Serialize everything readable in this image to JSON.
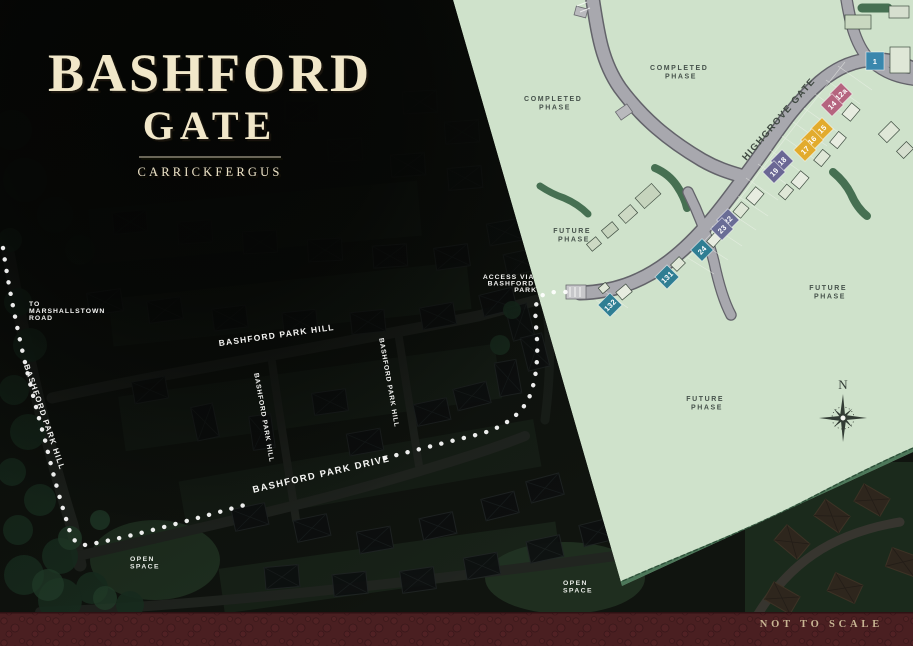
{
  "title": {
    "line1": "BASHFORD",
    "line2": "GATE",
    "subtitle": "CARRICKFERGUS"
  },
  "footer": {
    "scale_note": "NOT TO SCALE"
  },
  "aerial": {
    "to_road_lines": [
      "TO",
      "MARSHALLSTOWN",
      "ROAD"
    ],
    "park_hill": "BASHFORD PARK HILL",
    "park_drive": "BASHFORD PARK DRIVE",
    "access_lines": [
      "ACCESS VIA",
      "BASHFORD",
      "PARK"
    ],
    "open_space_lines": [
      "OPEN",
      "SPACE"
    ]
  },
  "plan": {
    "phase_completed_lines": [
      "COMPLETED",
      "PHASE"
    ],
    "phase_future_lines": [
      "FUTURE",
      "PHASE"
    ],
    "road_name": "HIGHGROVE GATE",
    "north": "N",
    "colors": {
      "plan_green": "#cfe2cb",
      "road_gray": "#a8a8ae",
      "hedge_green": "#3e694b",
      "footer_maroon": "#4a1f21",
      "title_cream": "#f1e7c9"
    },
    "plots": [
      {
        "number": "1",
        "color": "#3a87ad",
        "x": 875,
        "y": 61,
        "rot": 0,
        "size": 18
      },
      {
        "number": "12a",
        "color": "#b5647f",
        "x": 841,
        "y": 94,
        "rot": -45,
        "size": 16
      },
      {
        "number": "14",
        "color": "#b5647f",
        "x": 832,
        "y": 105,
        "rot": -45,
        "size": 16
      },
      {
        "number": "15",
        "color": "#e2ab2d",
        "x": 822,
        "y": 129,
        "rot": -45,
        "size": 16
      },
      {
        "number": "16",
        "color": "#e2ab2d",
        "x": 812,
        "y": 140,
        "rot": -45,
        "size": 16
      },
      {
        "number": "17",
        "color": "#e2ab2d",
        "x": 805,
        "y": 150,
        "rot": -45,
        "size": 16
      },
      {
        "number": "18",
        "color": "#6a6794",
        "x": 782,
        "y": 161,
        "rot": -45,
        "size": 16
      },
      {
        "number": "19",
        "color": "#6a6794",
        "x": 774,
        "y": 172,
        "rot": -45,
        "size": 16
      },
      {
        "number": "22",
        "color": "#6a6d96",
        "x": 728,
        "y": 220,
        "rot": -45,
        "size": 16
      },
      {
        "number": "23",
        "color": "#6a6d96",
        "x": 722,
        "y": 229,
        "rot": -45,
        "size": 16
      },
      {
        "number": "24",
        "color": "#2f7e93",
        "x": 702,
        "y": 250,
        "rot": -45,
        "size": 16
      },
      {
        "number": "131",
        "color": "#2f7e93",
        "x": 667,
        "y": 277,
        "rot": -45,
        "size": 17
      },
      {
        "number": "132",
        "color": "#2f7e93",
        "x": 610,
        "y": 305,
        "rot": -45,
        "size": 17
      }
    ]
  }
}
